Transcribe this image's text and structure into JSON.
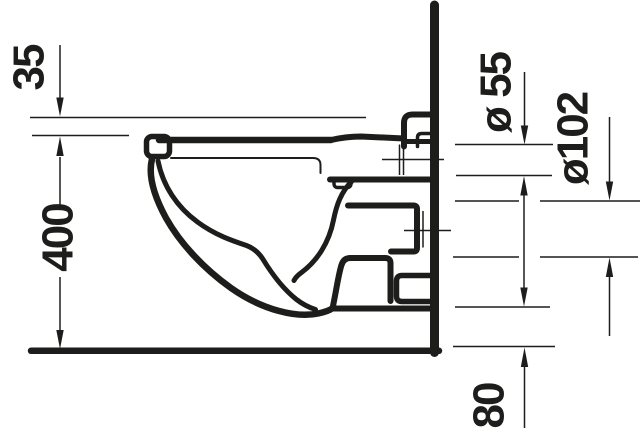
{
  "colors": {
    "line": "#1d1d1b",
    "background": "#ffffff"
  },
  "diagram": {
    "subject": "Wall-hung toilet side elevation technical drawing with installation dimensions",
    "dimensions": {
      "seat_top": "35",
      "height": "400",
      "flush_pipe": "ø 55",
      "outlet_pipe": "ø102",
      "clearance": "80"
    }
  }
}
